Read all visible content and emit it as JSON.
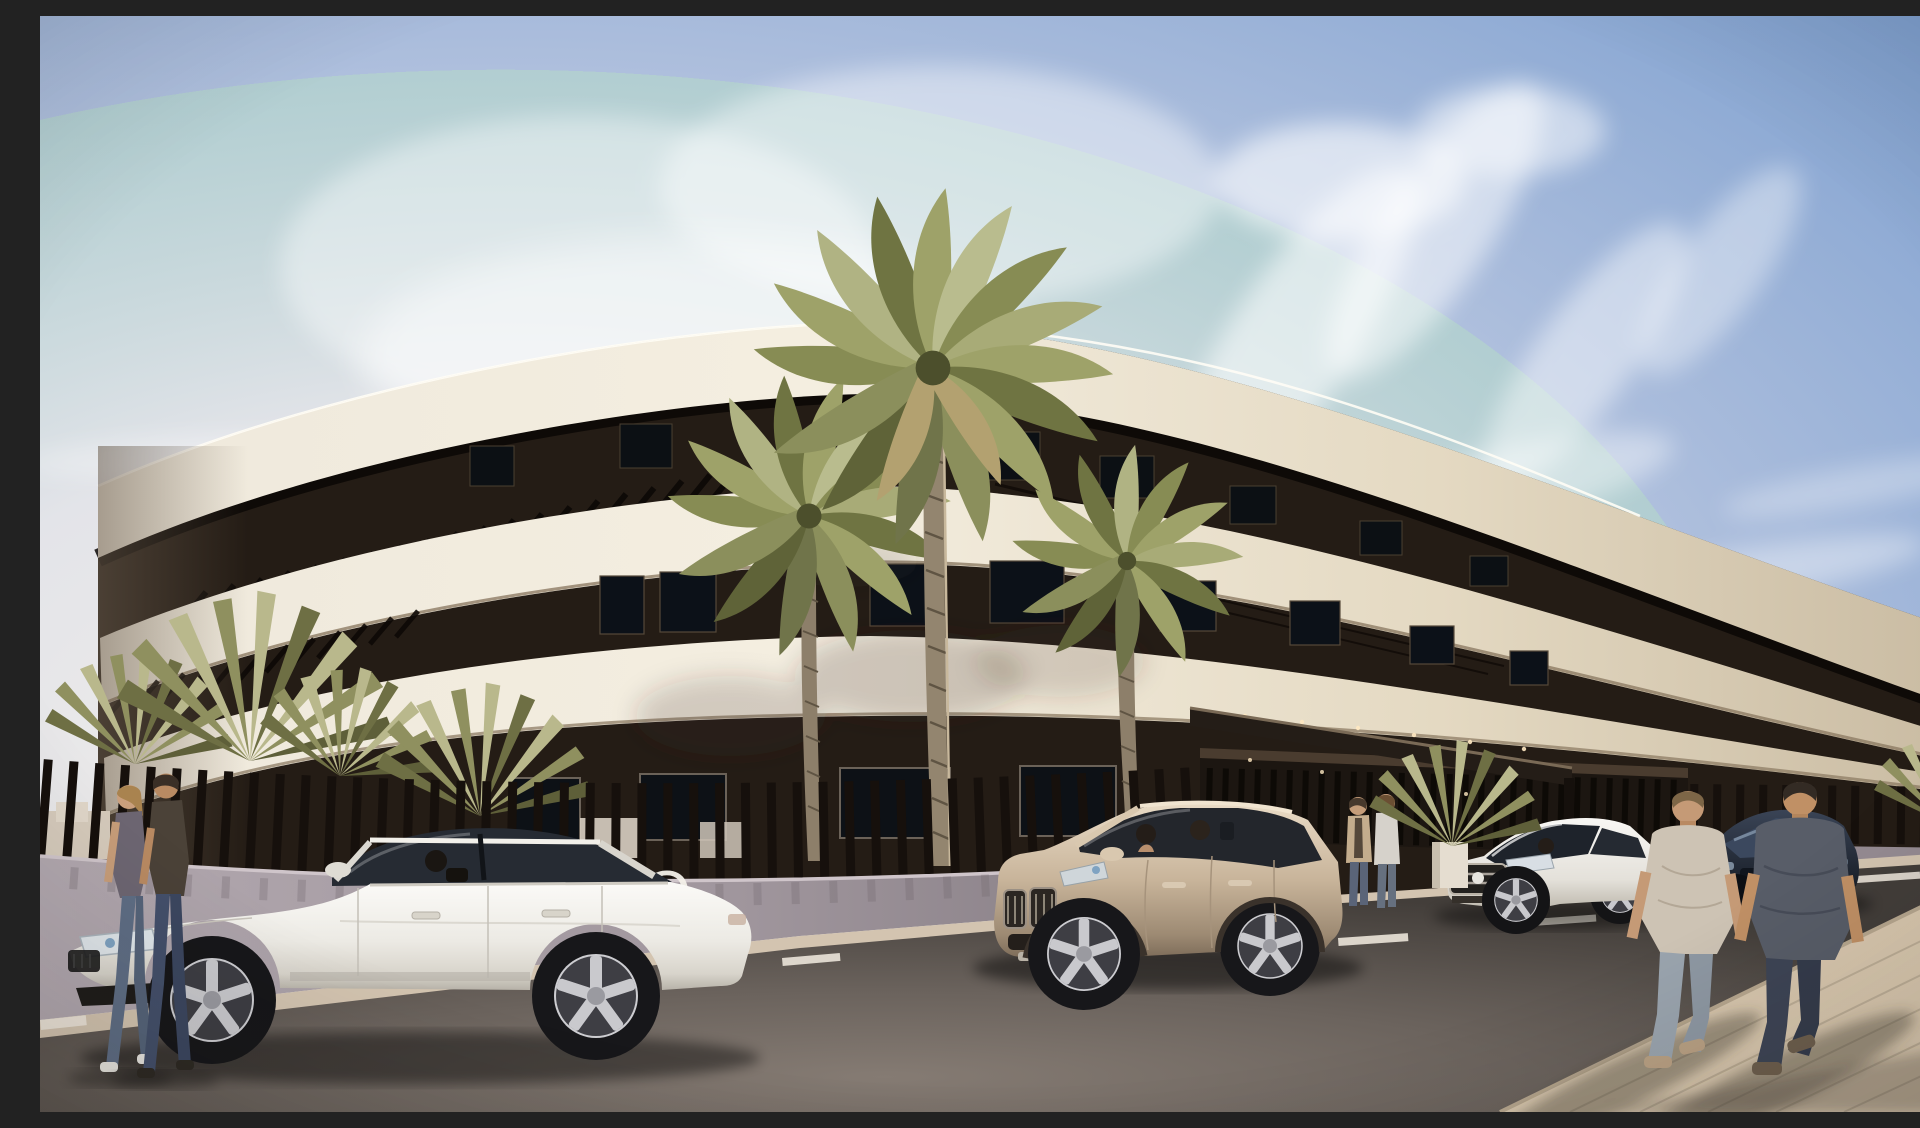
{
  "scene": {
    "type": "architectural-exterior-render",
    "setting": "Curved modern white apartment building with dark recessed terrace floors and pergola slats, palm trees, slatted perimeter fence, street with cars and pedestrians, sunny sky with cirrus clouds"
  },
  "signage": {
    "wall_text": "TO"
  },
  "palette": {
    "sky_blue": "#7b9ecf",
    "sky_haze": "#f3efe9",
    "building_band": "#efe7d6",
    "building_dark_floor": "#241c15",
    "fence_slats": "#16100c",
    "fence_wall": "#a49aa1",
    "road": "#6e6661",
    "sidewalk_tiles": "#d8c7ae",
    "palm_green": "#9aa06c",
    "suv_champagne": "#c8b49a",
    "sedan_white": "#f3f1ec",
    "mercedes_white": "#f0eeea",
    "dark_car": "#232a36"
  },
  "building": {
    "visible_floors": 3,
    "style": "sweeping horizontal white bands, dark glazed floors, rooftop pergola rafters, ground floor behind slatted fence",
    "entrance": "dark slatted entrance volume with flat canopy"
  },
  "vehicles": [
    {
      "name": "white-sedan",
      "color": "#f3f1ec",
      "view": "left profile, driving left, driver visible"
    },
    {
      "name": "champagne-suv",
      "color": "#c8b49a",
      "view": "front three-quarter, two occupants visible"
    },
    {
      "name": "white-mercedes-sedan",
      "color": "#f0eeea",
      "view": "front three-quarter, driver visible"
    },
    {
      "name": "dark-navy-car",
      "color": "#232a36",
      "view": "front, partially hidden behind pedestrians"
    }
  ],
  "people": [
    {
      "name": "woman-walking-left",
      "top": "gray t-shirt",
      "bottom": "blue jeans"
    },
    {
      "name": "man-walking-left",
      "top": "dark olive t-shirt",
      "bottom": "jeans"
    },
    {
      "name": "person-standing-entrance-left",
      "top": "beige cardigan"
    },
    {
      "name": "person-standing-entrance-right",
      "top": "light top"
    },
    {
      "name": "man-walking-away-light-tee",
      "top": "light gray t-shirt",
      "bottom": "light jeans"
    },
    {
      "name": "man-walking-away-dark-tee",
      "top": "slate t-shirt",
      "bottom": "dark jeans"
    }
  ],
  "vegetation": {
    "large_date_palms": 3,
    "fan_palm_clusters": 5
  },
  "road": {
    "markings": "short white dashes",
    "sidewalk": "light tiled pavement lower right with long shadows"
  }
}
